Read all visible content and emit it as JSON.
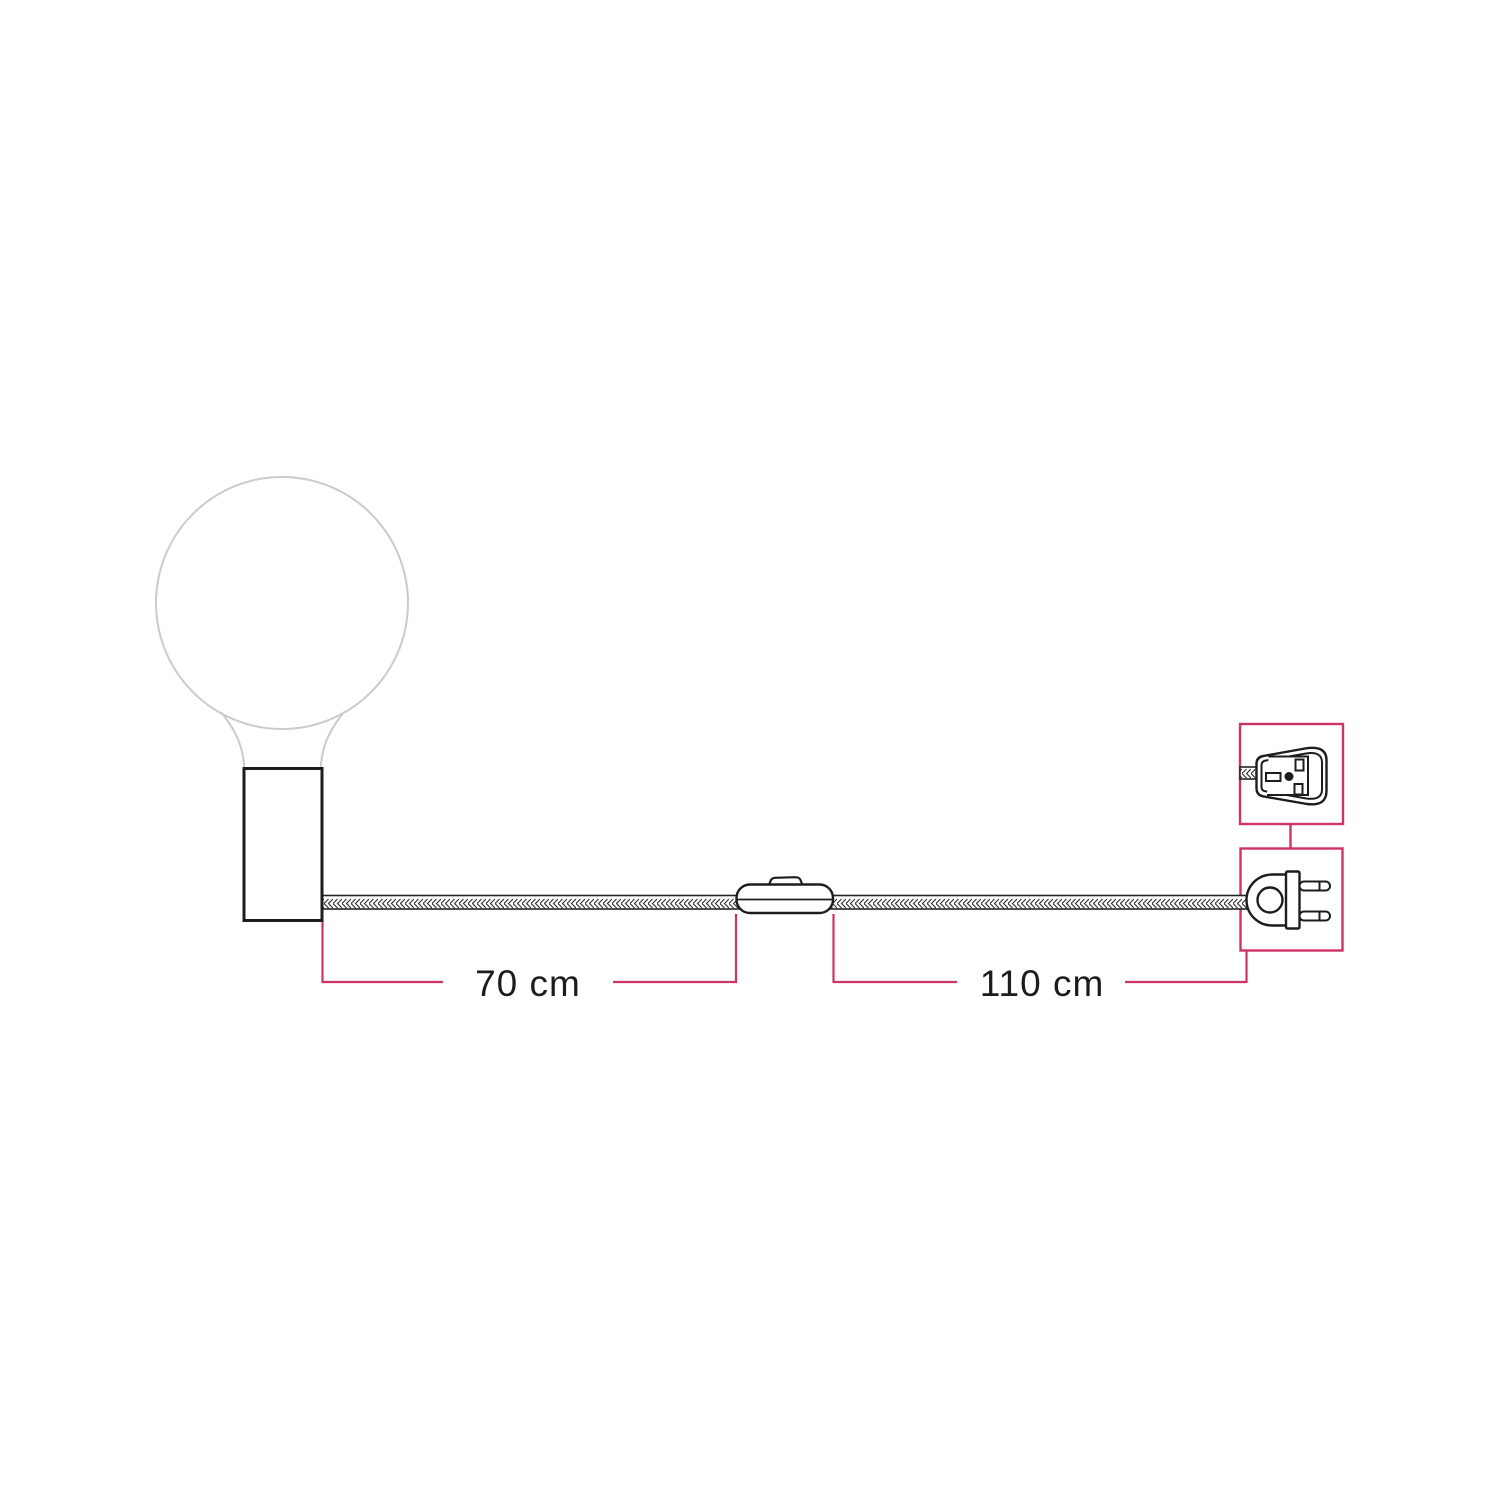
{
  "diagram": {
    "background": "#ffffff",
    "dimensions": {
      "holder_to_switch": {
        "label": "70 cm",
        "value": 70,
        "unit": "cm"
      },
      "switch_to_plug": {
        "label": "110 cm",
        "value": 110,
        "unit": "cm"
      }
    },
    "components": {
      "bulb": "globe-light-bulb",
      "lamp_holder": "cylinder-lamp-holder",
      "cable": "braided-textile-cable",
      "switch": "inline-switch",
      "plug": "eu-two-pin-plug",
      "plug_detail": "uk-plug-front-detail"
    },
    "colors": {
      "accent": "#cf3269",
      "outline": "#1d1d1d",
      "bulb_outline": "#cbcbcb"
    }
  }
}
